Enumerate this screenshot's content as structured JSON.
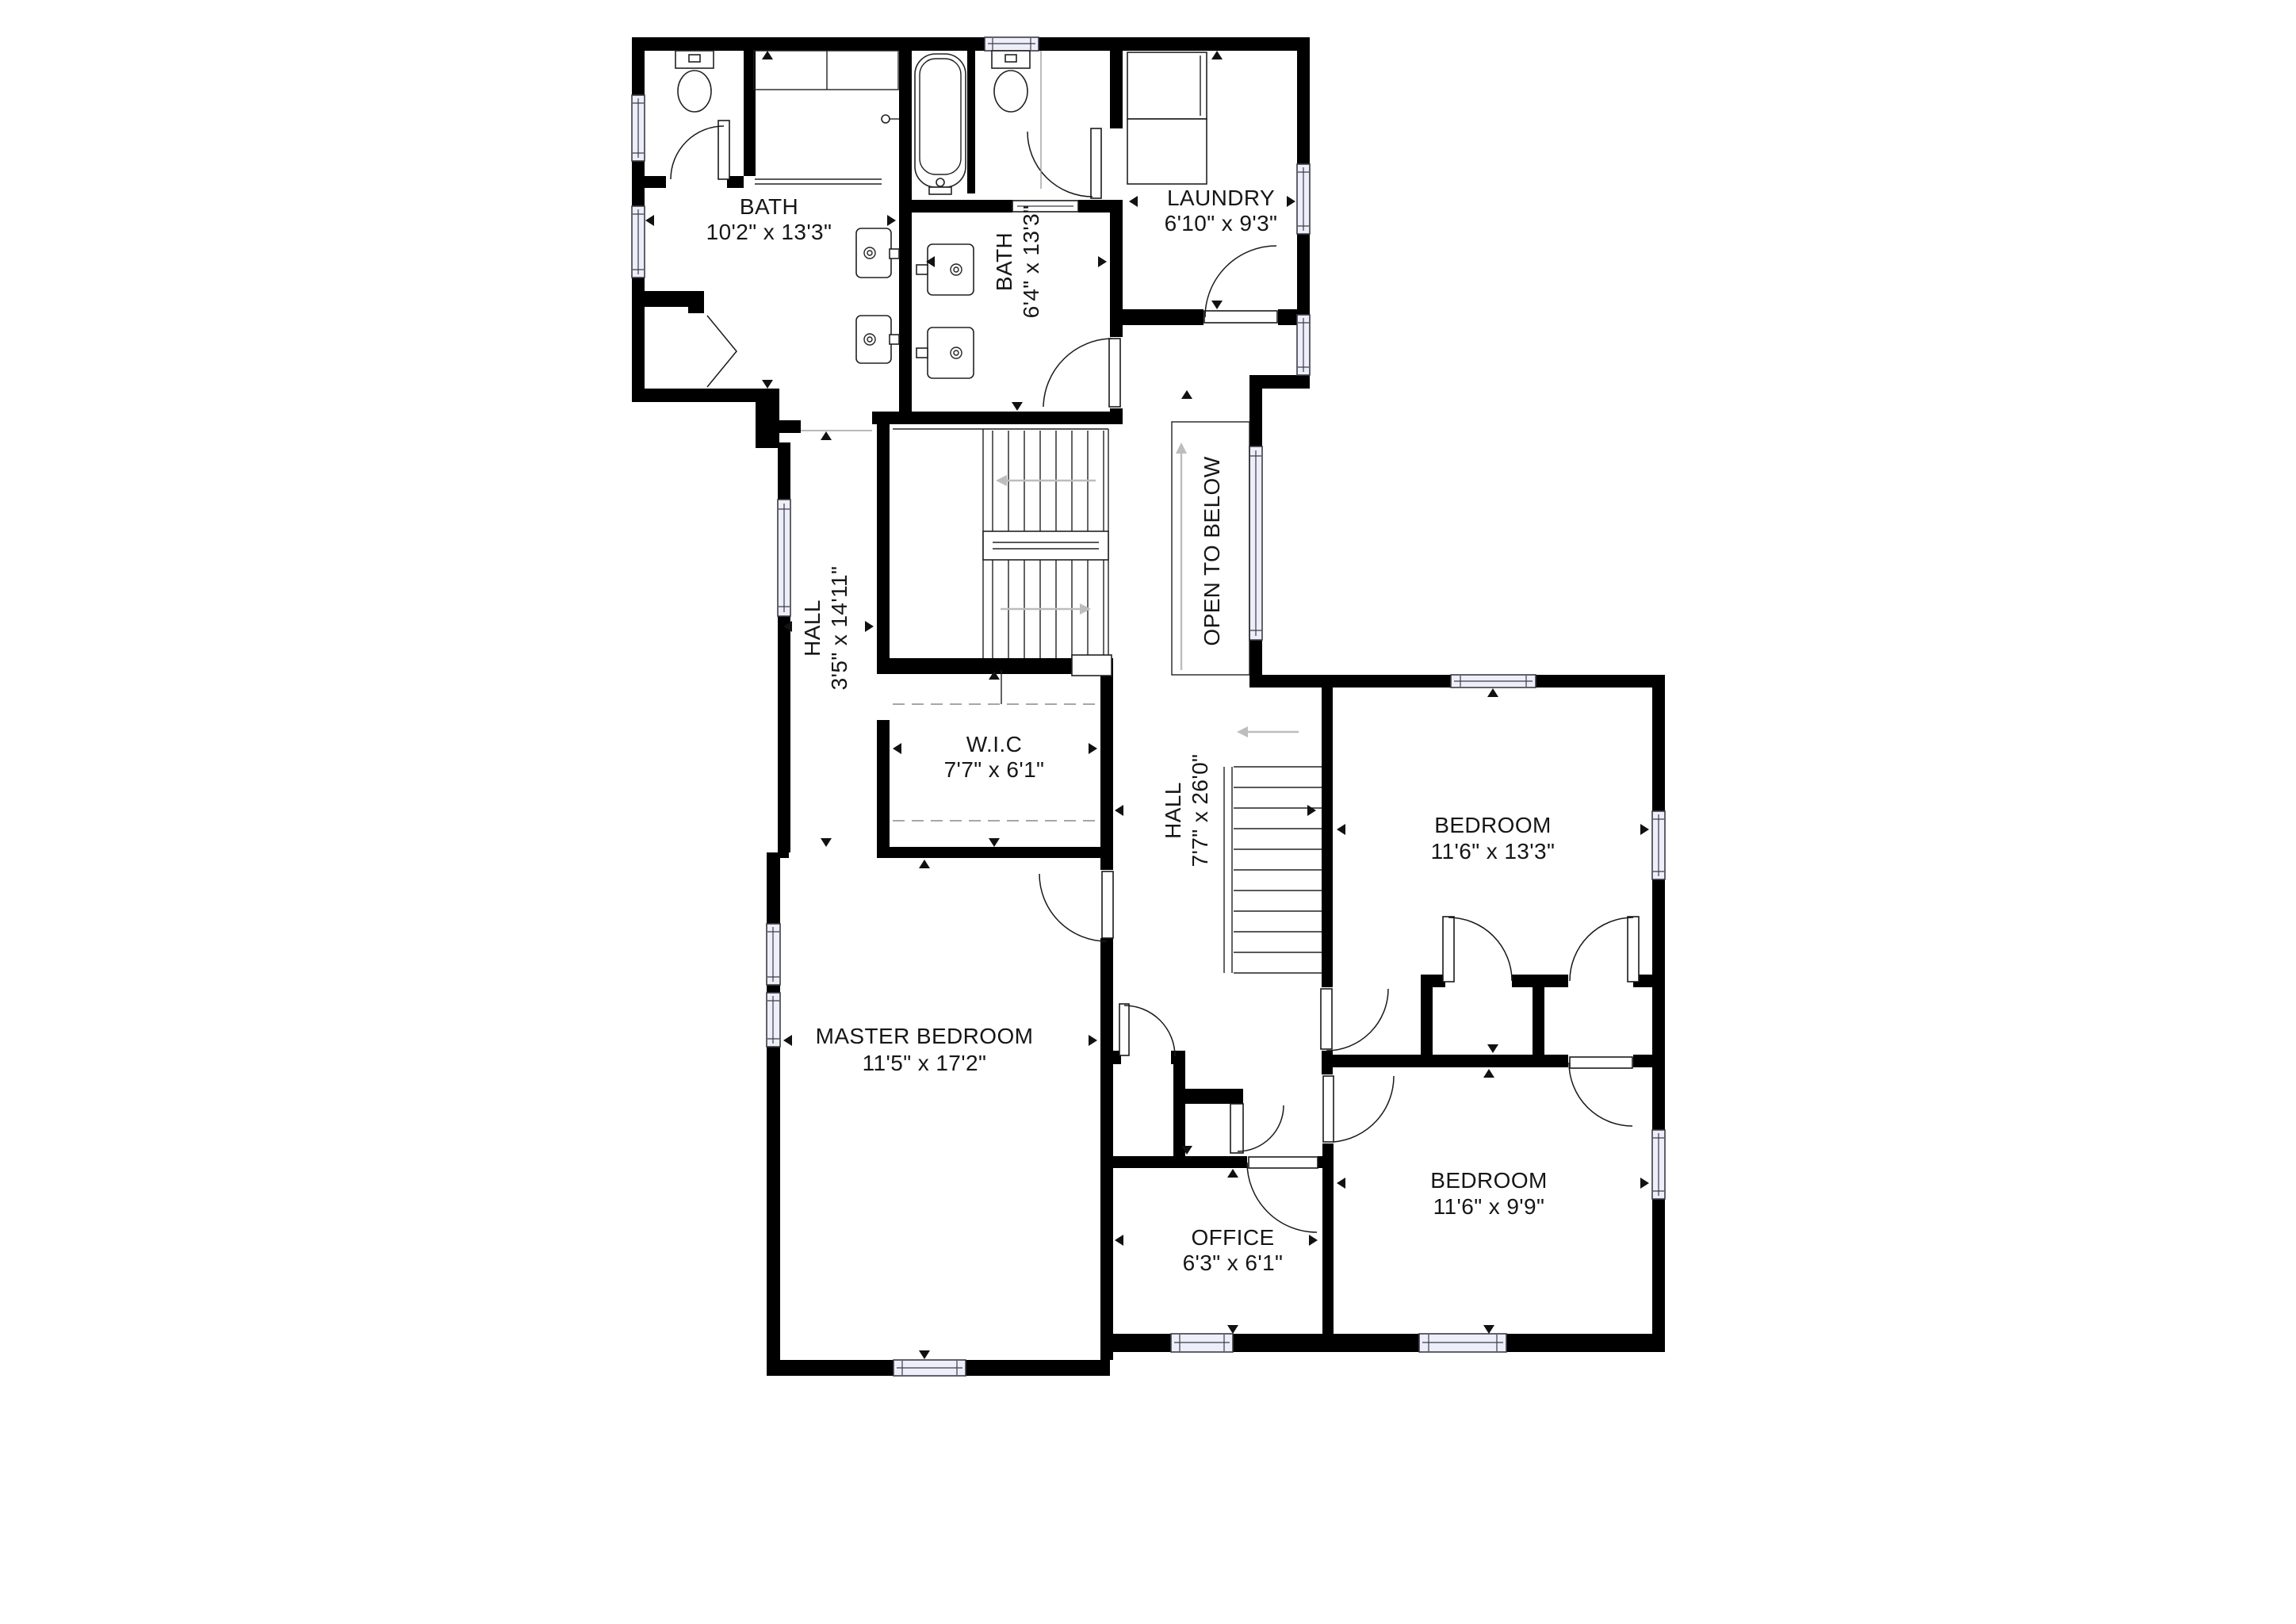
{
  "plan": {
    "meta": {
      "type": "floor-plan",
      "background_color": "#ffffff",
      "wall_color": "#000000",
      "window_fill_color": "#edeef9",
      "stair_arrow_color": "#bdbdbd",
      "text_color": "#161616"
    },
    "rooms": {
      "bath_main": {
        "name": "BATH",
        "dims": "10'2\" x 13'3\""
      },
      "bath_ensuite": {
        "name": "BATH",
        "dims": "6'4\" x 13'3\""
      },
      "laundry": {
        "name": "LAUNDRY",
        "dims": "6'10\" x 9'3\""
      },
      "hall_upper": {
        "name": "HALL",
        "dims": "3'5\" x 14'11\""
      },
      "open_below": {
        "name": "OPEN TO BELOW"
      },
      "wic": {
        "name": "W.I.C",
        "dims": "7'7\" x 6'1\""
      },
      "hall_main": {
        "name": "HALL",
        "dims": "7'7\" x 26'0\""
      },
      "bedroom_1": {
        "name": "BEDROOM",
        "dims": "11'6\" x 13'3\""
      },
      "master": {
        "name": "MASTER BEDROOM",
        "dims": "11'5\" x 17'2\""
      },
      "bedroom_2": {
        "name": "BEDROOM",
        "dims": "11'6\" x 9'9\""
      },
      "office": {
        "name": "OFFICE",
        "dims": "6'3\" x 6'1\""
      }
    }
  }
}
